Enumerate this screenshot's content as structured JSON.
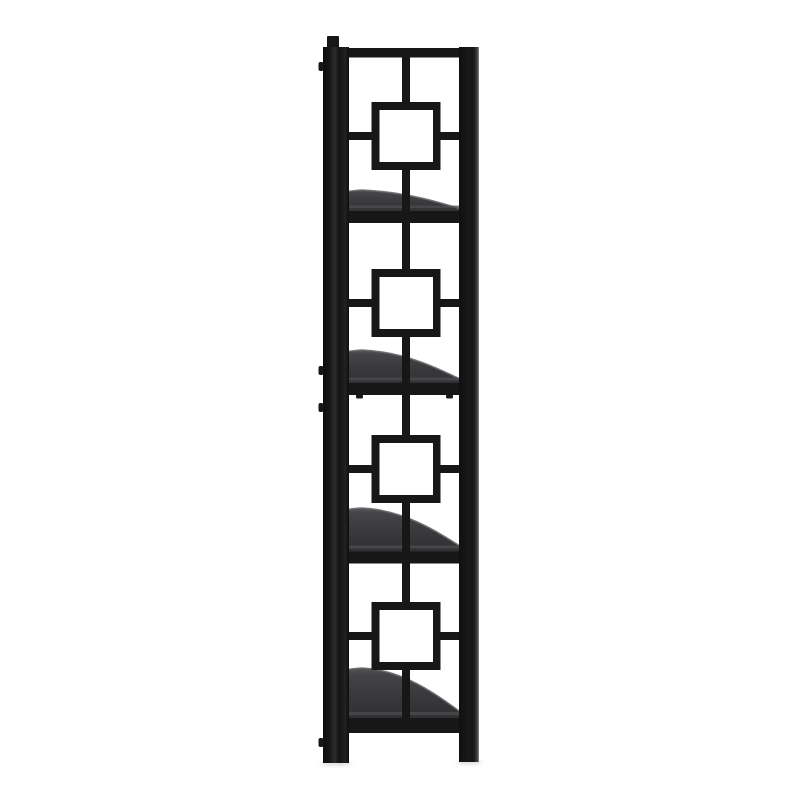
{
  "scene": {
    "type": "product photograph",
    "description": "Side profile of a tall narrow black metal etagere bookcase with four dark charcoal shelves and a nested-square lattice ornament, photographed on a seamless white background",
    "background_color": "#ffffff"
  },
  "product": {
    "name": "Black metal 4-shelf etagere bookcase - side elevation view",
    "frame_finish": "matte black metal tube",
    "shelf_count": 4,
    "motif": "nested square medallion lattice",
    "shelf_surface": "dark charcoal curved-front shelves",
    "view": "side elevation"
  },
  "colors": {
    "background": "#ffffff",
    "frame": "#171717",
    "frame_highlight": "#2d2d2d",
    "shelf_top": "#56565a",
    "shelf_upper": "#454548",
    "shelf_mid": "#3a3a3d",
    "shelf_bottom": "#2d2d30",
    "shelf_rim": "#6a6a6e",
    "shelf_edge_strip": "#4e4e52",
    "square_inner": "#ffffff",
    "floor_shadow": "#c4c4c4"
  },
  "shelves": [
    {
      "id": "shelf-1",
      "position": "top"
    },
    {
      "id": "shelf-2",
      "position": "upper-middle"
    },
    {
      "id": "shelf-3",
      "position": "lower-middle"
    },
    {
      "id": "shelf-4",
      "position": "bottom"
    }
  ]
}
